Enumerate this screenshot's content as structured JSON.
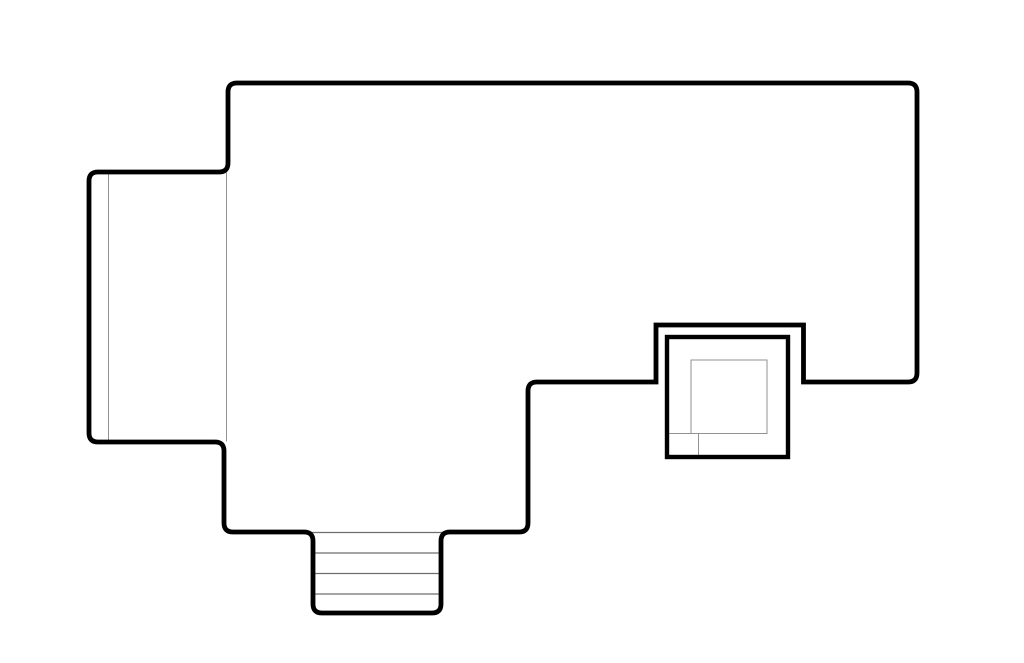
{
  "drawing": {
    "description": "architectural roof plan line drawing, no text labels",
    "canvas": {
      "width": 1024,
      "height": 663,
      "background": "#ffffff"
    },
    "palette": {
      "outline": "#000000",
      "detail": "#929292",
      "detail_dark": "#6e6e6e"
    },
    "paths": [
      {
        "name": "roof-outline",
        "stroke": "outline",
        "stroke_width": 4.8,
        "d": "M 237,83 L 908,83 Q 917,83 917,92 L 917,373 Q 917,382 908,382 L 803.5,382 L 803.5,325 L 656,325 L 656,382 L 537,382 Q 528,382 528,391 L 528,523 Q 528,532 519,532 L 450,532 Q 441,532 441,541 L 441,604 Q 441,613 432,613 L 322,613 Q 313,613 313,604 L 313,541 Q 313,532 304,532 L 233,532 Q 224,532 224,523 L 224,451 Q 224,442 215,442 L 98,442 Q 89,442 89,433 L 89,181 Q 89,172 98,172 L 219,172 L 219,172 Q 228,172 228,163 L 228,92 Q 228,83 237,83 Z"
      }
    ],
    "rects": [
      {
        "name": "chimney-flue-opening",
        "stroke": "detail",
        "stroke_width": 1,
        "x": 691,
        "y": 360,
        "width": 76,
        "height": 73.5
      },
      {
        "name": "chimney-curb",
        "stroke": "outline",
        "stroke_width": 4.4,
        "x": 667,
        "y": 337,
        "width": 121,
        "height": 120
      }
    ],
    "lines": [
      {
        "name": "left-wing-roof-detail-line",
        "stroke": "detail",
        "stroke_width": 1,
        "x1": 108.5,
        "y1": 172.5,
        "x2": 108.5,
        "y2": 441.5
      },
      {
        "name": "left-wing-junction-line",
        "stroke": "detail",
        "stroke_width": 1,
        "x1": 226.5,
        "y1": 172.5,
        "x2": 226.5,
        "y2": 441.5
      },
      {
        "name": "stairs-top-edge-line",
        "stroke": "detail_dark",
        "stroke_width": 1.2,
        "x1": 308,
        "y1": 532.5,
        "x2": 446,
        "y2": 532.5
      },
      {
        "name": "stairs-tread-line-1",
        "stroke": "detail_dark",
        "stroke_width": 1.2,
        "x1": 315.5,
        "y1": 553,
        "x2": 438.5,
        "y2": 553
      },
      {
        "name": "stairs-tread-line-2",
        "stroke": "detail_dark",
        "stroke_width": 1.2,
        "x1": 315.5,
        "y1": 573.5,
        "x2": 438.5,
        "y2": 573.5
      },
      {
        "name": "stairs-tread-line-3",
        "stroke": "detail_dark",
        "stroke_width": 1.2,
        "x1": 315.5,
        "y1": 594,
        "x2": 438.5,
        "y2": 594
      },
      {
        "name": "chimney-ledge-line-h",
        "stroke": "detail",
        "stroke_width": 1,
        "x1": 667,
        "y1": 433.5,
        "x2": 691,
        "y2": 433.5
      },
      {
        "name": "chimney-ledge-line-v",
        "stroke": "detail",
        "stroke_width": 1,
        "x1": 698.5,
        "y1": 433.5,
        "x2": 698.5,
        "y2": 456.5
      }
    ]
  }
}
